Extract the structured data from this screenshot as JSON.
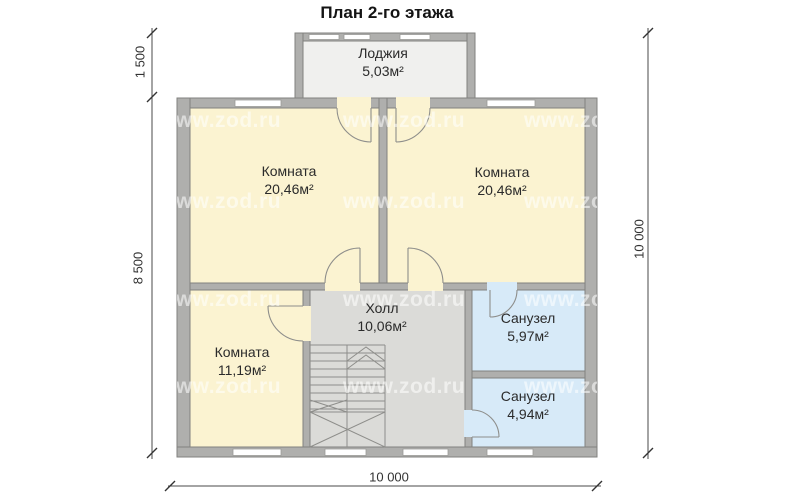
{
  "title": "План 2-го этажа",
  "watermark_text": "www.zod.ru",
  "rooms": {
    "loggia": {
      "name": "Лоджия",
      "area": "5,03м²"
    },
    "room_top_left": {
      "name": "Комната",
      "area": "20,46м²"
    },
    "room_top_right": {
      "name": "Комната",
      "area": "20,46м²"
    },
    "room_bottom_left": {
      "name": "Комната",
      "area": "11,19м²"
    },
    "hall": {
      "name": "Холл",
      "area": "10,06м²"
    },
    "bathroom_upper": {
      "name": "Санузел",
      "area": "5,97м²"
    },
    "bathroom_lower": {
      "name": "Санузел",
      "area": "4,94м²"
    }
  },
  "dimensions": {
    "left_upper": "1 500",
    "left_lower": "8 500",
    "right": "10 000",
    "bottom": "10 000"
  },
  "colors": {
    "room_fill": "#FBF3D1",
    "hall_fill": "#DBDBD8",
    "bathroom_fill": "#D7EAF8",
    "loggia_fill": "#F0F0EE",
    "wall_fill": "#AFAFAD",
    "wall_edge": "#82827F",
    "window_fill": "#FFFFFF",
    "dimension_color": "#333333"
  }
}
